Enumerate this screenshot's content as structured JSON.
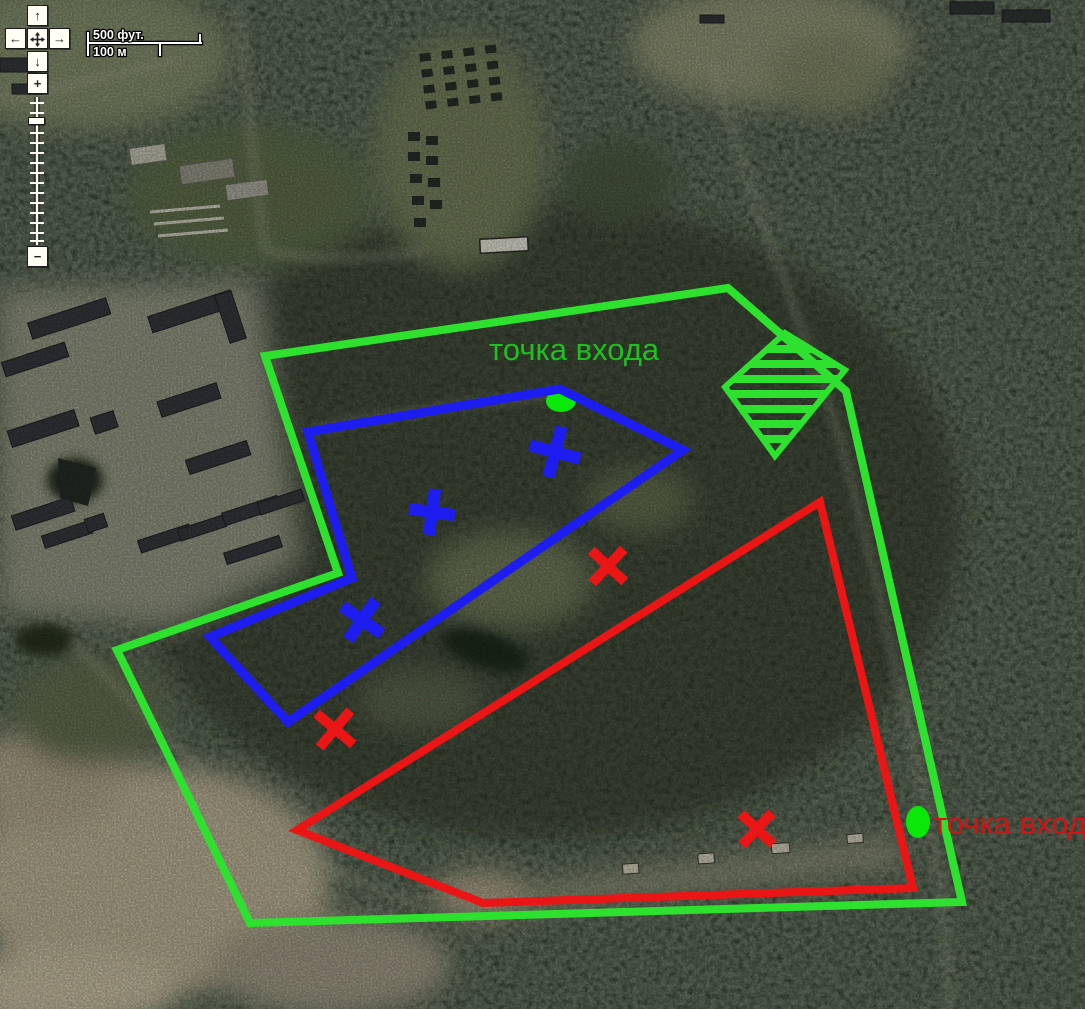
{
  "map": {
    "controls": {
      "pan_up": "↑",
      "pan_left": "←",
      "pan_right": "→",
      "pan_down": "↓",
      "zoom_in": "+",
      "zoom_out": "−"
    },
    "scale_bar": {
      "feet": "500 фут.",
      "meters": "100 м"
    }
  },
  "overlay": {
    "colors": {
      "green": "#2ee12e",
      "blue": "#1d1df0",
      "red": "#ea1515",
      "green_text": "#1ec01e",
      "red_text": "#cf1414",
      "dot": "#0ae80a"
    },
    "labels": [
      {
        "text": "точка входа",
        "color": "#1ec01e",
        "x": 489,
        "y": 334
      },
      {
        "text": "точка входа",
        "color": "#cf1414",
        "x": 933,
        "y": 808
      }
    ],
    "polygons": [
      {
        "name": "green-outer-boundary",
        "color": "#2ee12e",
        "width": 8,
        "points": [
          [
            265,
            356
          ],
          [
            728,
            288
          ],
          [
            846,
            391
          ],
          [
            962,
            902
          ],
          [
            250,
            923
          ],
          [
            117,
            650
          ],
          [
            338,
            573
          ]
        ]
      },
      {
        "name": "blue-area",
        "color": "#1d1df0",
        "width": 9,
        "points": [
          [
            560,
            389
          ],
          [
            683,
            450
          ],
          [
            288,
            722
          ],
          [
            210,
            637
          ],
          [
            352,
            578
          ],
          [
            308,
            432
          ]
        ]
      },
      {
        "name": "red-area",
        "color": "#ea1515",
        "width": 8,
        "points": [
          [
            820,
            502
          ],
          [
            913,
            888
          ],
          [
            483,
            903
          ],
          [
            297,
            830
          ]
        ]
      }
    ],
    "hatched_area": {
      "name": "green-hatched-zone",
      "color": "#2ee12e",
      "outline_width": 6,
      "stripe_width": 8,
      "stripe_spacing": 15,
      "points": [
        [
          725,
          387
        ],
        [
          785,
          333
        ],
        [
          845,
          370
        ],
        [
          775,
          456
        ]
      ]
    },
    "x_marks": [
      {
        "color": "#1d1df0",
        "x": 555,
        "y": 452,
        "size": 52,
        "stroke": 12,
        "angle": 15
      },
      {
        "color": "#1d1df0",
        "x": 432,
        "y": 512,
        "size": 46,
        "stroke": 12,
        "angle": 8
      },
      {
        "color": "#1d1df0",
        "x": 362,
        "y": 620,
        "size": 48,
        "stroke": 12,
        "angle": 35
      },
      {
        "color": "#ea1515",
        "x": 608,
        "y": 566,
        "size": 46,
        "stroke": 10,
        "angle": 43
      },
      {
        "color": "#ea1515",
        "x": 335,
        "y": 729,
        "size": 48,
        "stroke": 10,
        "angle": 40
      },
      {
        "color": "#ea1515",
        "x": 757,
        "y": 829,
        "size": 44,
        "stroke": 10,
        "angle": 43
      }
    ],
    "entry_dots": [
      {
        "x": 561,
        "y": 401,
        "rx": 15,
        "ry": 11
      },
      {
        "x": 918,
        "y": 822,
        "rx": 12,
        "ry": 16
      }
    ]
  }
}
